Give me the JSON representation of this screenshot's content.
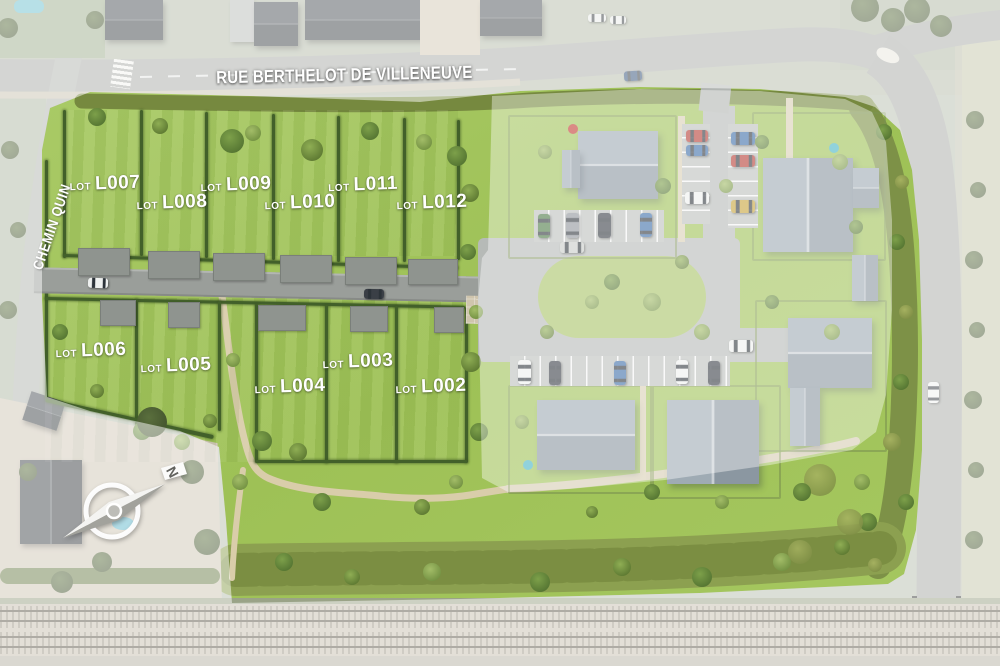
{
  "streets": {
    "main": "RUE BERTHELOT DE VILLENEUVE",
    "side": "CHEMIN QUIN"
  },
  "compass": {
    "north": "N"
  },
  "lot_prefix": "LOT",
  "lots": [
    {
      "code": "L007"
    },
    {
      "code": "L008"
    },
    {
      "code": "L009"
    },
    {
      "code": "L010"
    },
    {
      "code": "L011"
    },
    {
      "code": "L012"
    },
    {
      "code": "L006"
    },
    {
      "code": "L005"
    },
    {
      "code": "L004"
    },
    {
      "code": "L003"
    },
    {
      "code": "L002"
    }
  ],
  "colors": {
    "lawn": "#a3c45f",
    "hedge": "#42602a",
    "road": "#9a9e9a",
    "path": "#d9cdaa",
    "roof": "#95a0a9",
    "rail_bed": "#c6bfae",
    "label_text": "#ffffff"
  }
}
